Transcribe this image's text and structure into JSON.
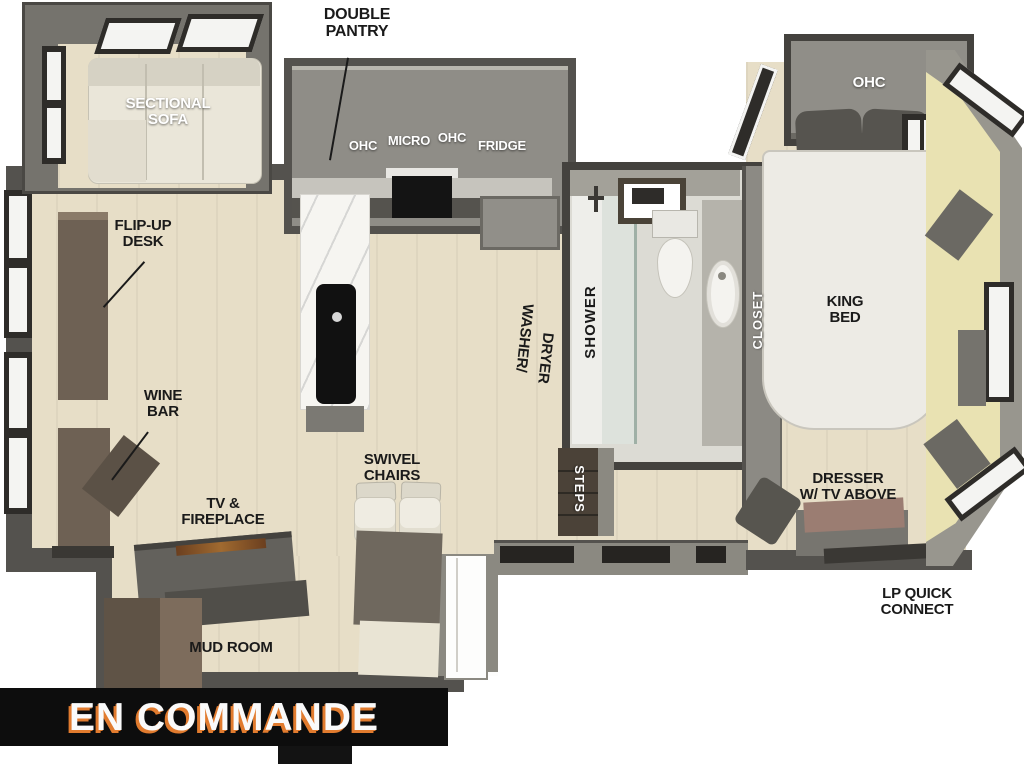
{
  "page": {
    "background": "#ffffff"
  },
  "banner": {
    "text": "EN COMMANDE",
    "bg_color": "#0d0d0d",
    "text_color": "#fafafa",
    "accent_color": "#e17b2e"
  },
  "floorplan": {
    "type": "rv-floor-plan",
    "labels": {
      "double_pantry": "DOUBLE\nPANTRY",
      "sectional_sofa": "SECTIONAL\nSOFA",
      "ohc_kitchen_left": "OHC",
      "micro": "MICRO",
      "ohc_kitchen_right": "OHC",
      "fridge": "FRIDGE",
      "flip_up_desk": "FLIP-UP\nDESK",
      "wine_bar": "WINE\nBAR",
      "tv_fireplace": "TV &\nFIREPLACE",
      "swivel_chairs": "SWIVEL\nCHAIRS",
      "mud_room": "MUD ROOM",
      "washer_line1": "WASHER/",
      "washer_line2": "DRYER",
      "shower": "SHOWER",
      "steps": "STEPS",
      "closet": "CLOSET",
      "ohc_bedroom": "OHC",
      "king_bed": "KING\nBED",
      "dresser": "DRESSER\nW/ TV ABOVE",
      "lp_quick_connect": "LP QUICK\nCONNECT"
    },
    "colors": {
      "floor": "#e7dec7",
      "floor_rear_cap": "#e9e2b2",
      "wall_dark": "#54524e",
      "wall_mid": "#8b8981",
      "cabinet_gray": "#8f8d87",
      "furniture_brown": "#6e6154",
      "sofa_cream": "#eae6d9",
      "bed_white": "#edebe5",
      "dresser_top": "#9b7d72",
      "steps_brown": "#4b4238",
      "label_black": "#1a1a1a",
      "label_white": "#ffffff"
    }
  }
}
